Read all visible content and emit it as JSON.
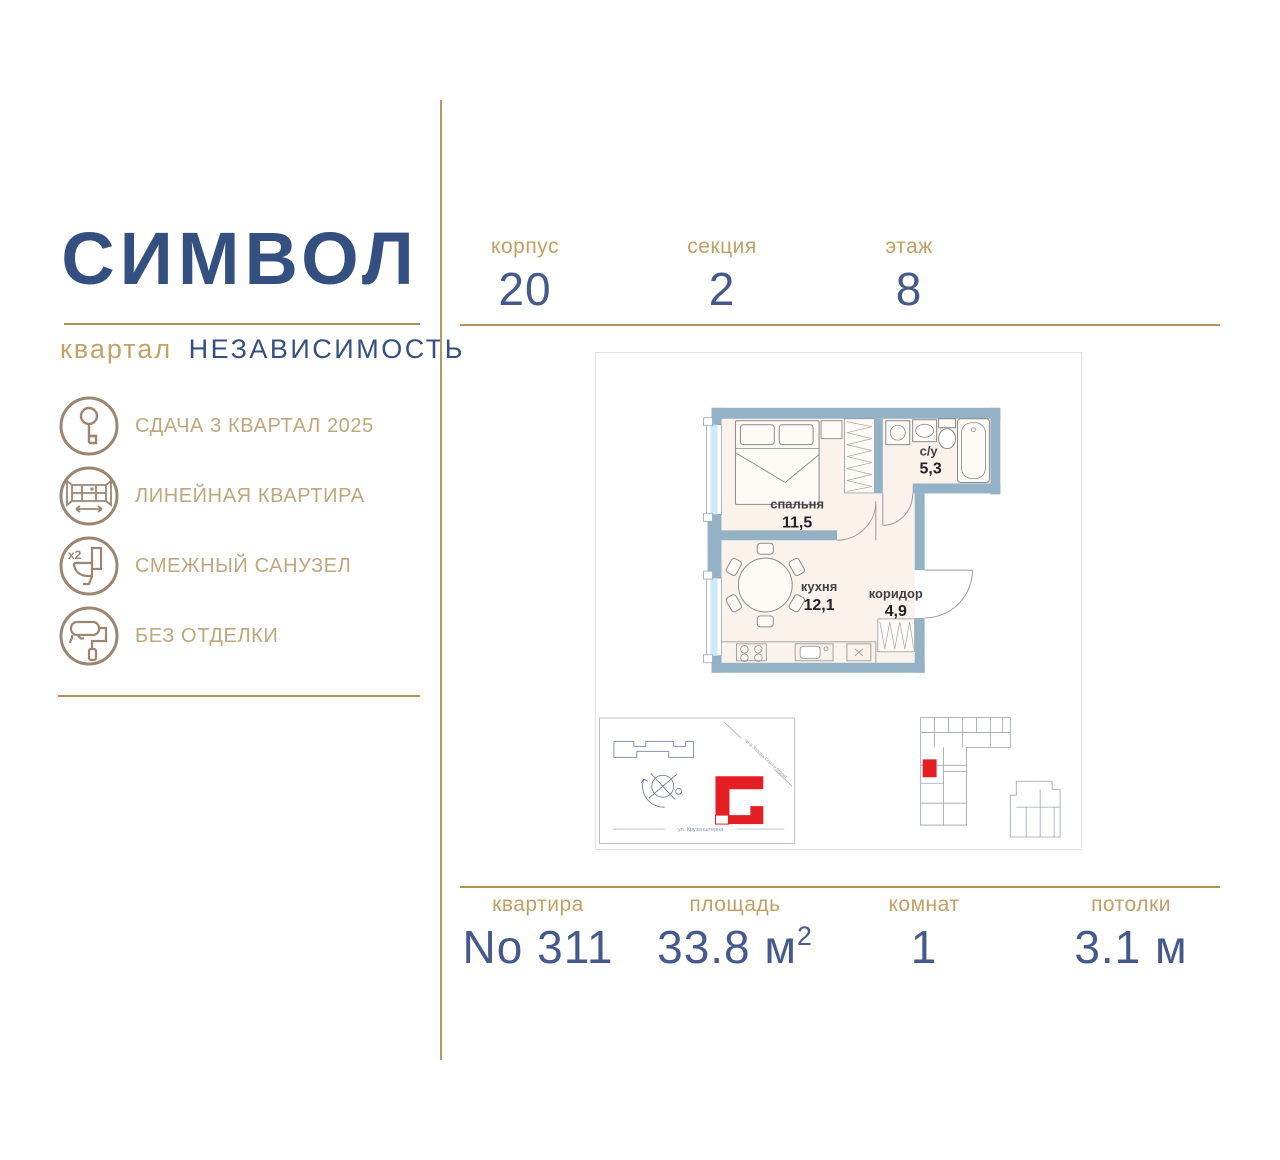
{
  "brand": {
    "logo": "СИМВОЛ",
    "district_label": "квартал",
    "district": "НЕЗАВИСИМОСТЬ"
  },
  "features": [
    {
      "icon": "key-icon",
      "label": "СДАЧА 3 КВАРТАЛ 2025"
    },
    {
      "icon": "panoramic-window-icon",
      "label": "ЛИНЕЙНАЯ КВАРТИРА"
    },
    {
      "icon": "toilet-icon",
      "label": "СМЕЖНЫЙ САНУЗЕЛ",
      "badge": "х2"
    },
    {
      "icon": "paint-roller-icon",
      "label": "БЕЗ ОТДЕЛКИ"
    }
  ],
  "unit_top": [
    {
      "label": "корпус",
      "value": "20"
    },
    {
      "label": "секция",
      "value": "2"
    },
    {
      "label": "этаж",
      "value": "8"
    }
  ],
  "unit_bottom": [
    {
      "label": "квартира",
      "value": "No 311",
      "sup": ""
    },
    {
      "label": "площадь",
      "value": "33.8 м",
      "sup": "2"
    },
    {
      "label": "комнат",
      "value": "1",
      "sup": ""
    },
    {
      "label": "потолки",
      "value": "3.1 м",
      "sup": ""
    }
  ],
  "floor_plan": {
    "rooms": [
      {
        "name": "спальня",
        "area": "11,5"
      },
      {
        "name": "с/у",
        "area": "5,3"
      },
      {
        "name": "кухня",
        "area": "12,1"
      },
      {
        "name": "коридор",
        "area": "4,9"
      }
    ],
    "site_map": {
      "street_diagonal": "пр-д Завода Серп и Молот",
      "street_bottom": "ул. Крузенштерна"
    }
  },
  "colors": {
    "brand_blue": "#345080",
    "accent_gold": "#C2A266",
    "line_gold": "#B29254",
    "icon_brown": "#9C8672",
    "wall_blue": "#93B2C5",
    "floor_cream": "#FBF2EB",
    "highlight_red": "#E31E24"
  }
}
